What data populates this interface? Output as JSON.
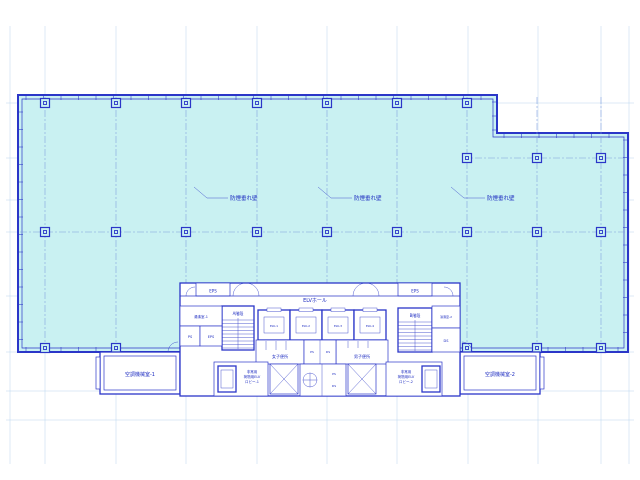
{
  "drawing": {
    "floor_area_label": "防煙垂れ壁",
    "core": {
      "eps": "EPS",
      "elv_hall": "ELVホール",
      "stair_a": "A階段",
      "stair_b": "B階段",
      "kitchenette_1": "湯沸室-1",
      "kitchenette_2": "湯沸室-2",
      "womens_wc": "女子便所",
      "mens_wc": "男子便所",
      "elevators": [
        "ELV-1",
        "ELV-2",
        "ELV-3",
        "ELV-4"
      ],
      "lobby_1": {
        "line1": "非常用",
        "line2": "荷物用ELV",
        "line3": "ロビー-1"
      },
      "lobby_2": {
        "line1": "非常用",
        "line2": "荷物用ELV",
        "line3": "ロビー-2"
      },
      "shaft_ps": "PS",
      "shaft_eps": "EPS",
      "shaft_ds": "DS"
    },
    "wings": {
      "left": "空調機械室-1",
      "right": "空調機械室-2"
    },
    "colors": {
      "floor_fill": "#c9f1f2",
      "line_blue": "#2b36c8",
      "grid_blue": "#b9d5ee",
      "text_blue": "#1b2ac0",
      "background": "#ffffff"
    }
  },
  "plan_geometry": {
    "grid_v": [
      10,
      45,
      116,
      186,
      257,
      327,
      397,
      468,
      538,
      601,
      629
    ],
    "grid_h": [
      103,
      158,
      200,
      232,
      296,
      352,
      391,
      420
    ],
    "centerlines_v": [
      45,
      116,
      186,
      257,
      327,
      397,
      467,
      537,
      601
    ],
    "centerlines_h": [
      {
        "y": 232,
        "x0": 20,
        "x1": 626
      },
      {
        "y": 158,
        "x0": 462,
        "x1": 626
      }
    ],
    "columns": [
      [
        45,
        103
      ],
      [
        116,
        103
      ],
      [
        186,
        103
      ],
      [
        257,
        103
      ],
      [
        327,
        103
      ],
      [
        397,
        103
      ],
      [
        467,
        103
      ],
      [
        467,
        158
      ],
      [
        537,
        158
      ],
      [
        601,
        158
      ],
      [
        45,
        232
      ],
      [
        116,
        232
      ],
      [
        186,
        232
      ],
      [
        257,
        232
      ],
      [
        327,
        232
      ],
      [
        397,
        232
      ],
      [
        467,
        232
      ],
      [
        537,
        232
      ],
      [
        601,
        232
      ],
      [
        45,
        348
      ],
      [
        116,
        348
      ],
      [
        467,
        348
      ],
      [
        537,
        348
      ],
      [
        601,
        348
      ]
    ],
    "tick_runs_h": [
      {
        "y": 95,
        "x0": 26,
        "x1": 492,
        "step": 17.5,
        "len": 5
      },
      {
        "y": 133,
        "x0": 504,
        "x1": 624,
        "step": 17.5,
        "len": 5
      },
      {
        "y": 347,
        "x0": 26,
        "x1": 96,
        "step": 17.5,
        "len": 5
      },
      {
        "y": 347,
        "x0": 548,
        "x1": 624,
        "step": 17.5,
        "len": 5
      }
    ],
    "tick_runs_v": [
      {
        "x": 18,
        "y0": 112,
        "y1": 345,
        "step": 17.5,
        "len": 5
      },
      {
        "x": 623,
        "y0": 140,
        "y1": 345,
        "step": 17.5,
        "len": 5
      },
      {
        "x": 492,
        "y0": 102,
        "y1": 130,
        "step": 14,
        "len": 5
      }
    ],
    "stair_treads": [
      {
        "x0": 222,
        "x1": 254,
        "y0": 320,
        "y1": 349,
        "step": 3.5
      },
      {
        "x0": 398,
        "x1": 432,
        "y0": 322,
        "y1": 351,
        "step": 3.5
      }
    ]
  }
}
